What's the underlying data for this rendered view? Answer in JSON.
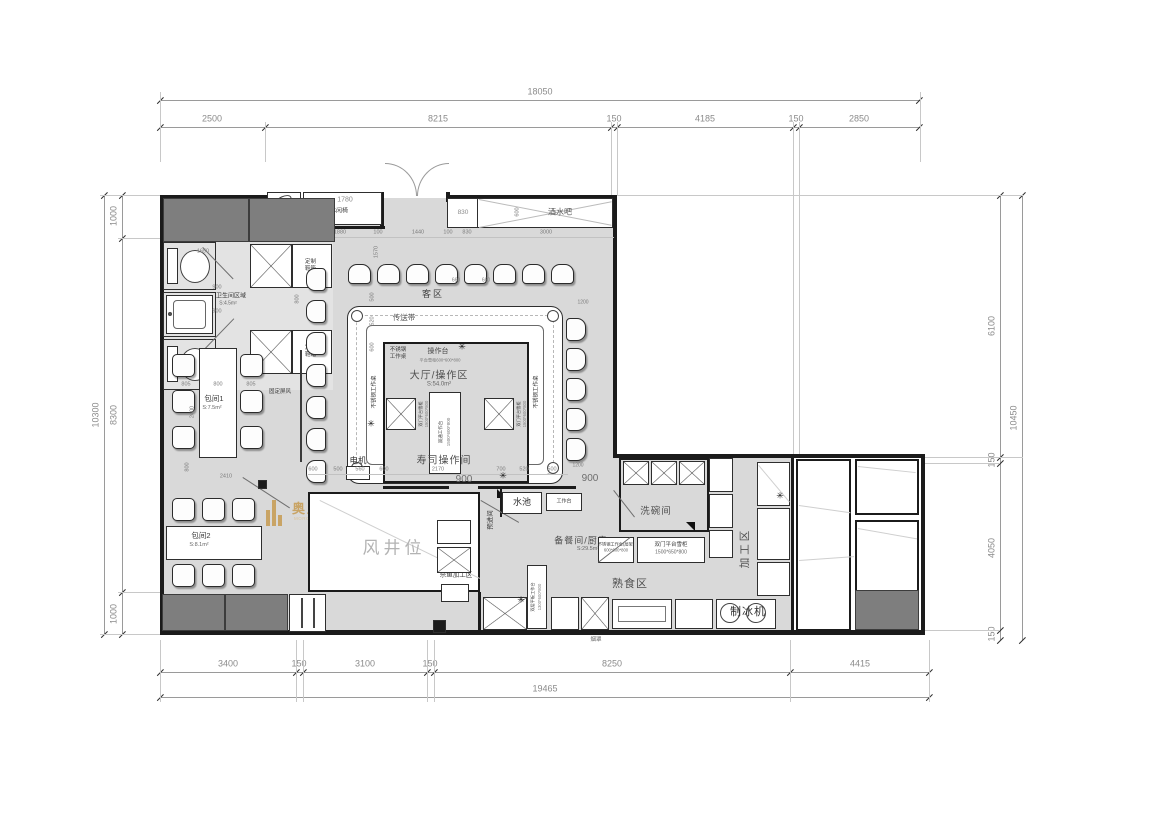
{
  "watermark": {
    "cn": "奥川建筑空间设计",
    "en": "MORCHUEN BUILDING SPACE DESIGN",
    "gold": "#c9a465"
  },
  "chains": {
    "top_total": "18050",
    "top": [
      "2500",
      "8215",
      "150",
      "4185",
      "150",
      "2850"
    ],
    "bottom": [
      "3400",
      "150",
      "3100",
      "150",
      "8250",
      "4415"
    ],
    "bottom_total": "19465",
    "left": [
      "1000",
      "8300",
      "1000"
    ],
    "left_total": "10300",
    "right": [
      "6100",
      "150",
      "4050",
      "150"
    ],
    "right_total": "10450"
  },
  "rooms": {
    "keqv": "客区",
    "belt": "传送带",
    "hall": "大厅/操作区",
    "hall_area": "S:54.0m²",
    "sushi": "寿司操作间",
    "windshaft": "风井位",
    "preentry": "预进间",
    "pool": "水池",
    "worktop": "工作台",
    "prep": "备餐间/厨房",
    "prep_area": "S:29.5m²",
    "sashimi1": "刺身间或",
    "sashimi2": "杀鱼加工区",
    "dishwash": "洗碗间",
    "cooked": "熟食区",
    "process": "加工区",
    "ice": "制冰机",
    "toilet": "卫生间区域",
    "toilet_area": "S:4.5m²",
    "room1": "包间1",
    "room1_area": "S:7.5m²",
    "room2": "包间2",
    "room2_area": "S:8.1m²",
    "screen": "固定屏风",
    "bar": "酒水吧",
    "bench": "日式休闲椅",
    "hydrant": "消火栓",
    "shoebox": "定制鞋箱",
    "motor": "电机",
    "hood": "烟罩"
  },
  "equip": {
    "ss_desk": "不锈钢工作桌",
    "ss_desk2": "不锈钢",
    "ss_desk2b": "工作桌",
    "console": "操作台",
    "fridge_s": "平台雪柜600*600*800",
    "dbl_work1": "双通工作台",
    "dbl_work2": "1500*600*800",
    "dbl_fridge": "双门平台雪柜",
    "dbl_fridge_sz": "1500*600*800",
    "cook_fridge": "双门平台雪柜",
    "cook_fridge_sz": "1500*650*800",
    "shelf1": "不锈钢工作台(层架)",
    "shelf2": "600*600*800",
    "flat1": "双层平板工作台",
    "flat2": "1300*600*800"
  },
  "d": {
    "bench": "1780",
    "t765": "765",
    "t1880": "1880",
    "t100a": "100",
    "t1440": "1440",
    "t100b": "100",
    "t830": "830",
    "t3000": "3000",
    "bar830": "830",
    "bar600": "600",
    "w1650": "1650",
    "w900a": "900",
    "w900b": "900",
    "w800": "800",
    "r805a": "805",
    "r800": "800",
    "r805b": "805",
    "r2400": "2400",
    "r2410": "2410",
    "r800b": "800",
    "v1570": "1570",
    "v500": "500",
    "v520": "520",
    "v600": "600",
    "b600a": "600",
    "b500a": "500",
    "b560": "560",
    "b600b": "600",
    "b2170": "2170",
    "b700": "700",
    "b520": "520",
    "b500b": "500",
    "door900a": "900",
    "door900b": "900",
    "s1200a": "1200",
    "s1200b": "1200",
    "s660a": "660",
    "s660b": "660"
  }
}
